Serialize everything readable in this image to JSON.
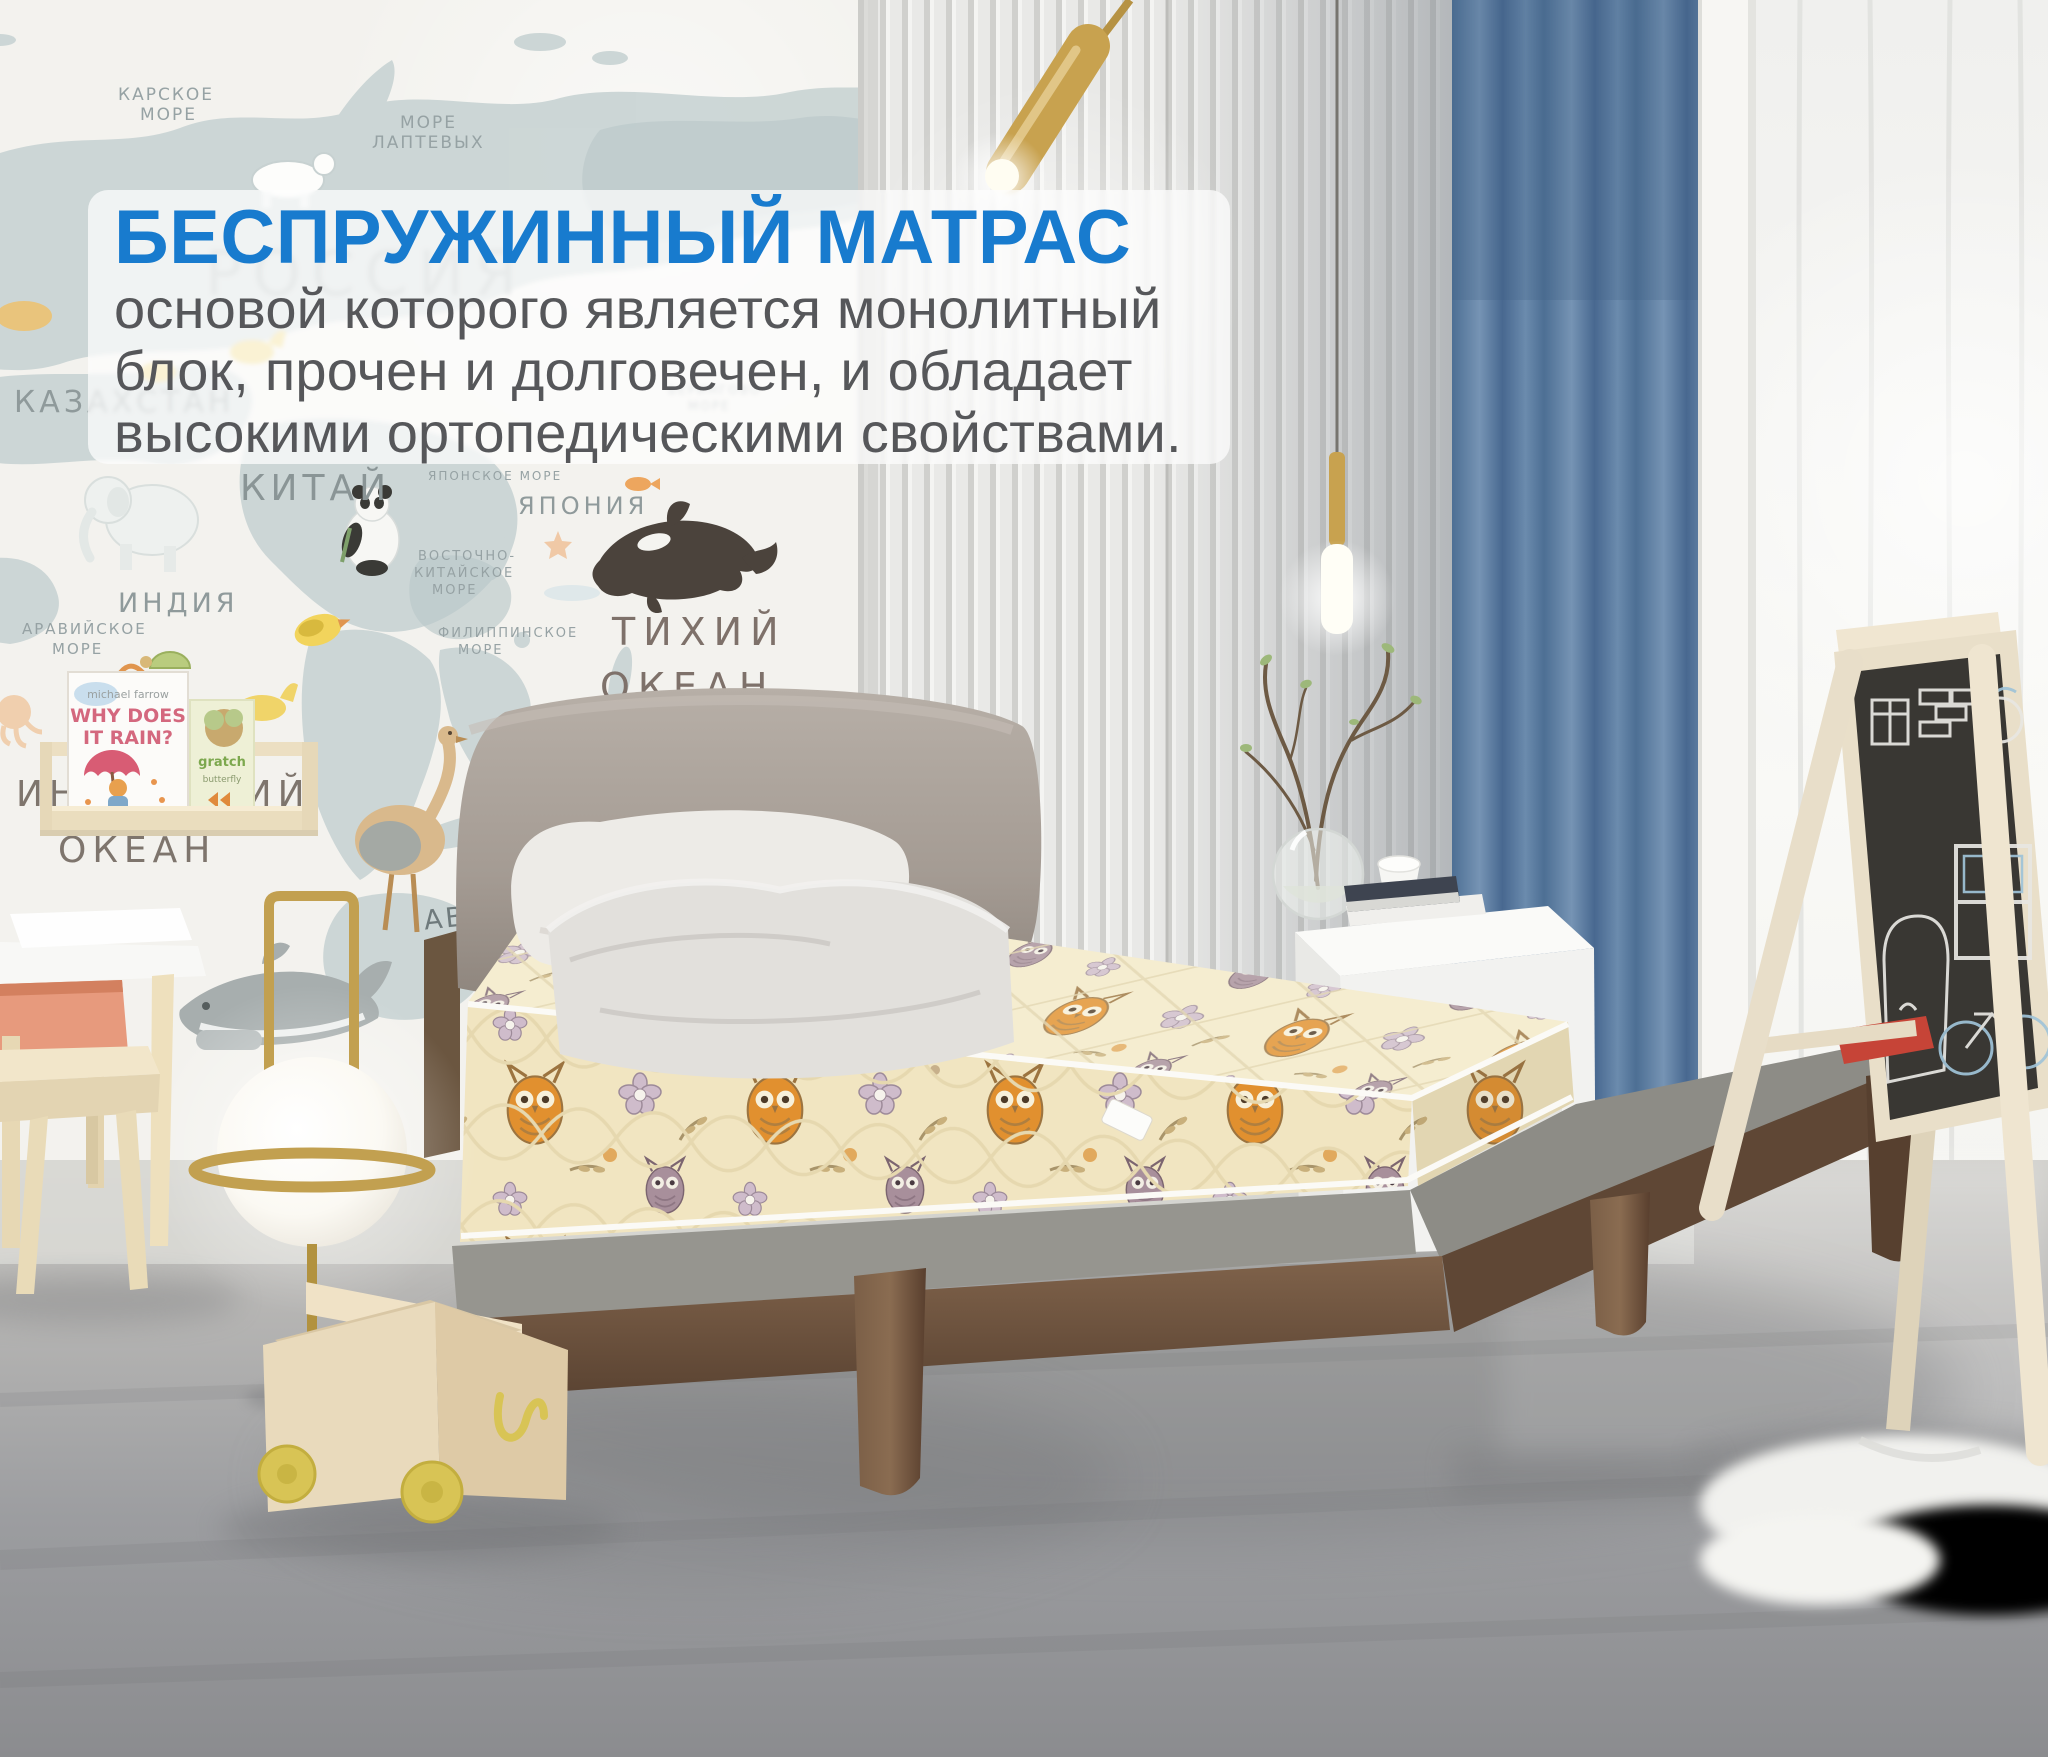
{
  "overlay": {
    "title": "БЕСПРУЖИННЫЙ МАТРАС",
    "lines": [
      "основой которого является монолитный",
      "блок, прочен и долговечен, и обладает",
      "высокими ортопедическими свойствами."
    ],
    "title_color": "#187bce",
    "text_color": "#56575a",
    "panel_bg": "rgba(255,255,255,0.72)"
  },
  "wall_map": {
    "labels": [
      "КАРСКОЕ",
      "МОРЕ",
      "МОРЕ",
      "ЛАПТЕВЫХ",
      "РОССИЯ",
      "КАЗАХСТАН",
      "КИТАЙ",
      "ИНДИЯ",
      "АРАВИЙСКОЕ",
      "МОРЕ",
      "ЯПОНИЯ",
      "ЯПОНСКОЕ МОРЕ",
      "ВОСТОЧНО-",
      "КИТАЙСКОЕ",
      "МОРЕ",
      "ФИЛИППИНСКОЕ",
      "МОРЕ",
      "ТИХИЙ",
      "ОКЕАН",
      "ИНДИЙСКИЙ",
      "ОКЕАН",
      "ABC",
      "БЕРИНГОВО",
      "МОРЕ"
    ]
  },
  "bookshelf": {
    "book1_author": "michael farrow",
    "book1_title_line1": "WHY DOES",
    "book1_title_line2": "IT RAIN?",
    "book2_line1": "gratch",
    "book2_line2": "butterfly"
  },
  "colors": {
    "accent_blue": "#187bce",
    "body_text_gray": "#56575a",
    "curtain_blue": "#5f81a5",
    "mattress_cream": "#f1e5c1",
    "owl_orange": "#e1902f",
    "wood_walnut": "#6e5138",
    "lamp_brass": "#c2a050",
    "floor_gray": "#9a9b9d",
    "map_land": "#c9d4d4"
  }
}
